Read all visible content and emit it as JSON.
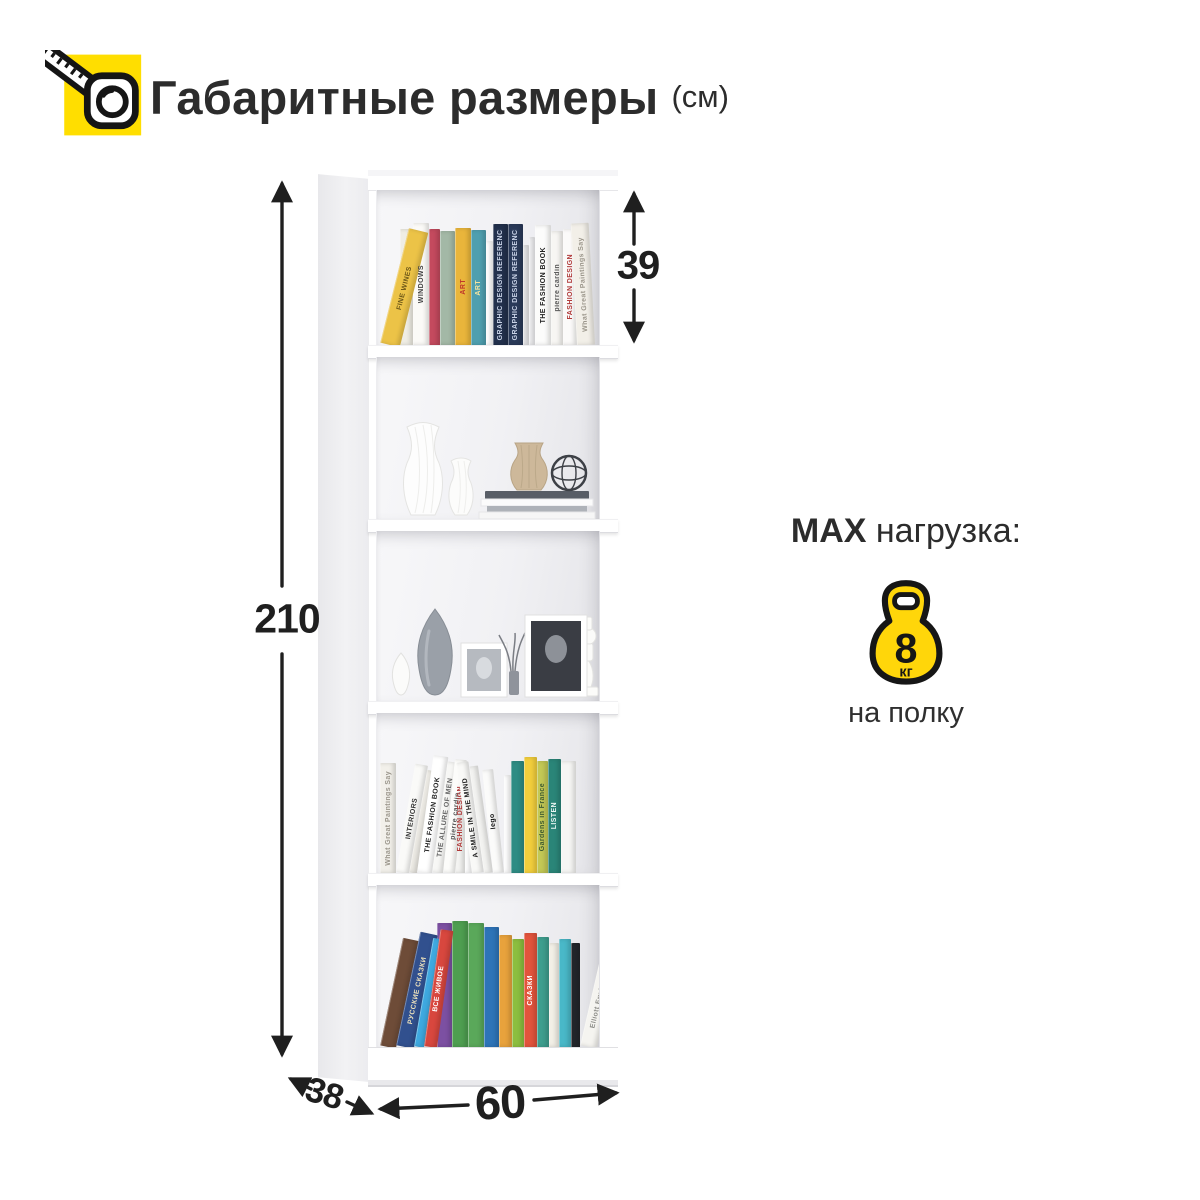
{
  "header": {
    "title": "Габаритные размеры",
    "unit_label": "(см)"
  },
  "dimensions": {
    "height_cm": "210",
    "top_shelf_height_cm": "39",
    "depth_cm": "38",
    "width_cm": "60"
  },
  "max_load": {
    "prefix": "MAX",
    "label": "нагрузка:",
    "value": "8",
    "unit": "кг",
    "suffix": "на полку"
  },
  "colors": {
    "accent_yellow": "#FFDE00",
    "kettlebell_yellow": "#FFD60A",
    "dimension_ink": "#1F1F1F"
  },
  "icons": [
    "tape-measure-icon",
    "kettlebell-icon"
  ],
  "bookcase": {
    "shelf_count": 5,
    "shelves": [
      {
        "name": "shelf-1",
        "type": "books",
        "books": [
          {
            "color": "#ECC347",
            "w": 20,
            "h": 118,
            "tilt": 14,
            "label": "FINE WINES",
            "text_color": "#6b5618"
          },
          {
            "color": "#EFEDE4",
            "w": 13,
            "h": 116
          },
          {
            "color": "#FBFAF7",
            "w": 16,
            "h": 122,
            "label": "WINDOWS",
            "text_color": "#444444"
          },
          {
            "color": "#C44A5E",
            "w": 11,
            "h": 116
          },
          {
            "color": "#A3B8A6",
            "w": 15,
            "h": 114
          },
          {
            "color": "#E9B53B",
            "w": 16,
            "h": 117,
            "label": "ART",
            "text_color": "#C0392B"
          },
          {
            "color": "#4F9FAF",
            "w": 15,
            "h": 115,
            "label": "ART",
            "text_color": "#F2E3A0"
          },
          {
            "color": "#FFFFFF",
            "w": 7,
            "h": 104
          },
          {
            "color": "#22304C",
            "w": 15,
            "h": 121,
            "label": "GRAPHIC DESIGN REFERENCED",
            "text_color": "#C8D2E6"
          },
          {
            "color": "#2A3A59",
            "w": 15,
            "h": 121,
            "label": "GRAPHIC DESIGN REFERENCED",
            "text_color": "#C8D2E6"
          },
          {
            "color": "#E9E9EB",
            "w": 6,
            "h": 100
          },
          {
            "color": "#F2F2F4",
            "w": 6,
            "h": 108
          },
          {
            "color": "#FCFCFB",
            "w": 16,
            "h": 120,
            "label": "THE FASHION BOOK",
            "text_color": "#222222"
          },
          {
            "color": "#F7F6F3",
            "w": 12,
            "h": 114,
            "label": "pierre cardin",
            "text_color": "#555555"
          },
          {
            "color": "#FBFAF9",
            "w": 14,
            "h": 116,
            "label": "FASHION DESIGN",
            "text_color": "#B03A3A"
          },
          {
            "color": "#F2EFE8",
            "w": 18,
            "h": 122,
            "tilt": -3,
            "label": "What Great Paintings Say",
            "text_color": "#9A958A"
          }
        ]
      },
      {
        "name": "shelf-2",
        "type": "decor",
        "items": [
          "ribbed-vase-tall",
          "ribbed-vase-small",
          "pleated-vase",
          "wire-sphere",
          "book-stack"
        ]
      },
      {
        "name": "shelf-3",
        "type": "decor",
        "items": [
          "drop-vase",
          "teardrop-vase",
          "photo-frame-small",
          "bottle-with-twigs",
          "photo-frame-large",
          "candlestick"
        ]
      },
      {
        "name": "shelf-4",
        "type": "books",
        "books": [
          {
            "color": "#F2F0EA",
            "w": 16,
            "h": 110,
            "label": "What Great Paintings Say",
            "text_color": "#9A958A"
          },
          {
            "color": "#FAFAF8",
            "w": 13,
            "h": 110,
            "tilt": 10,
            "label": "INTERIORS",
            "text_color": "#333333"
          },
          {
            "color": "#EDEBE5",
            "w": 8,
            "h": 104,
            "tilt": 10
          },
          {
            "color": "#FFFFFF",
            "w": 15,
            "h": 118,
            "tilt": 8,
            "label": "THE FASHION BOOK",
            "text_color": "#222222"
          },
          {
            "color": "#F7F7F5",
            "w": 11,
            "h": 112,
            "tilt": 8,
            "label": "THE ALLURE OF MEN",
            "text_color": "#666666"
          },
          {
            "color": "#FCFCFA",
            "w": 12,
            "h": 114,
            "tilt": 6,
            "label": "pierre cardin",
            "text_color": "#555555"
          },
          {
            "color": "#F4F4F2",
            "w": 10,
            "h": 108,
            "label": "FASHION DESIGN",
            "text_color": "#B03A3A"
          },
          {
            "color": "#FFFFFF",
            "w": 7,
            "h": 100
          },
          {
            "color": "#F9F9F7",
            "w": 12,
            "h": 112,
            "tilt": -8,
            "label": "A SMILE IN THE MIND",
            "text_color": "#222222"
          },
          {
            "color": "#F3F3F1",
            "w": 9,
            "h": 108,
            "tilt": -8
          },
          {
            "color": "#FBFBFA",
            "w": 11,
            "h": 104,
            "tilt": -6,
            "label": "lego",
            "text_color": "#111111"
          },
          {
            "color": "#FFFFFF",
            "w": 7,
            "h": 98
          },
          {
            "color": "#2E8C84",
            "w": 13,
            "h": 112
          },
          {
            "color": "#F2CE3C",
            "w": 13,
            "h": 116
          },
          {
            "color": "#C3C855",
            "w": 11,
            "h": 112,
            "label": "Gardens in France",
            "text_color": "#3F5A2F"
          },
          {
            "color": "#2A8578",
            "w": 13,
            "h": 114,
            "label": "LISTEN",
            "text_color": "#EAF5F2"
          },
          {
            "color": "#F6F6F4",
            "w": 15,
            "h": 112
          }
        ]
      },
      {
        "name": "shelf-5",
        "type": "books",
        "books": [
          {
            "color": "#6E4C38",
            "w": 16,
            "h": 110,
            "tilt": 12
          },
          {
            "color": "#31508E",
            "w": 18,
            "h": 116,
            "tilt": 12,
            "label": "РУССКИЕ СКАЗКИ",
            "text_color": "#EFE3BC"
          },
          {
            "color": "#3FA9E0",
            "w": 10,
            "h": 110,
            "tilt": 10
          },
          {
            "color": "#D8473E",
            "w": 13,
            "h": 118,
            "tilt": 8,
            "label": "ВСЁ ЖИВОЕ",
            "text_color": "#FFFFFF"
          },
          {
            "color": "#7C50A2",
            "w": 15,
            "h": 124
          },
          {
            "color": "#4E9E50",
            "w": 16,
            "h": 126
          },
          {
            "color": "#5AA85A",
            "w": 16,
            "h": 124
          },
          {
            "color": "#2E74B8",
            "w": 15,
            "h": 120
          },
          {
            "color": "#E8A23C",
            "w": 13,
            "h": 112
          },
          {
            "color": "#8CBE3F",
            "w": 12,
            "h": 108
          },
          {
            "color": "#E2543C",
            "w": 13,
            "h": 114,
            "label": "СКАЗКИ",
            "text_color": "#FFFFFF"
          },
          {
            "color": "#3E9E8E",
            "w": 12,
            "h": 110
          },
          {
            "color": "#F2EFE6",
            "w": 10,
            "h": 104
          },
          {
            "color": "#49B8C8",
            "w": 12,
            "h": 108
          },
          {
            "color": "#23262B",
            "w": 9,
            "h": 104
          },
          {
            "color": "#F5F4F0",
            "w": 17,
            "h": 110,
            "tilt": 13,
            "label": "Elliott Erwitt Snaps",
            "text_color": "#8A8A86"
          }
        ]
      }
    ]
  }
}
